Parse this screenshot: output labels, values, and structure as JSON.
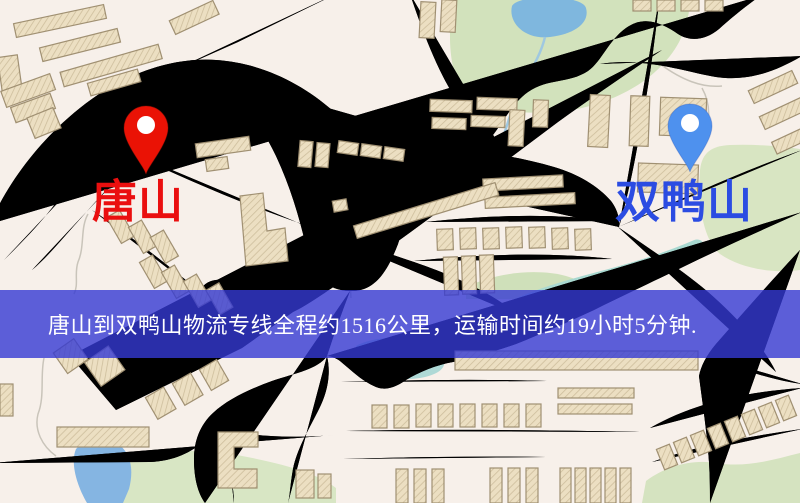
{
  "banner": {
    "text": "唐山到双鸭山物流专线全程约1516公里，运输时间约19小时5分钟.",
    "background": "#3e40cc",
    "text_color": "#ffffff"
  },
  "markers": {
    "origin": {
      "label": "唐山",
      "label_color": "#ea0f0f",
      "pin_color": "#ea1205",
      "pin_icon": "red-location-pin-icon"
    },
    "destination": {
      "label": "双鸭山",
      "label_color": "#2b4ce2",
      "pin_color": "#4e91ee",
      "pin_icon": "blue-location-pin-icon"
    }
  },
  "palette": {
    "map_background": "#f7f0ea",
    "road": "#f8d687",
    "park_green": "#d2e2bc",
    "water_blue": "#8fc3e3",
    "river_teal": "#a8d8d0",
    "building": "#ecdfc2",
    "railway": "#3a352e"
  }
}
